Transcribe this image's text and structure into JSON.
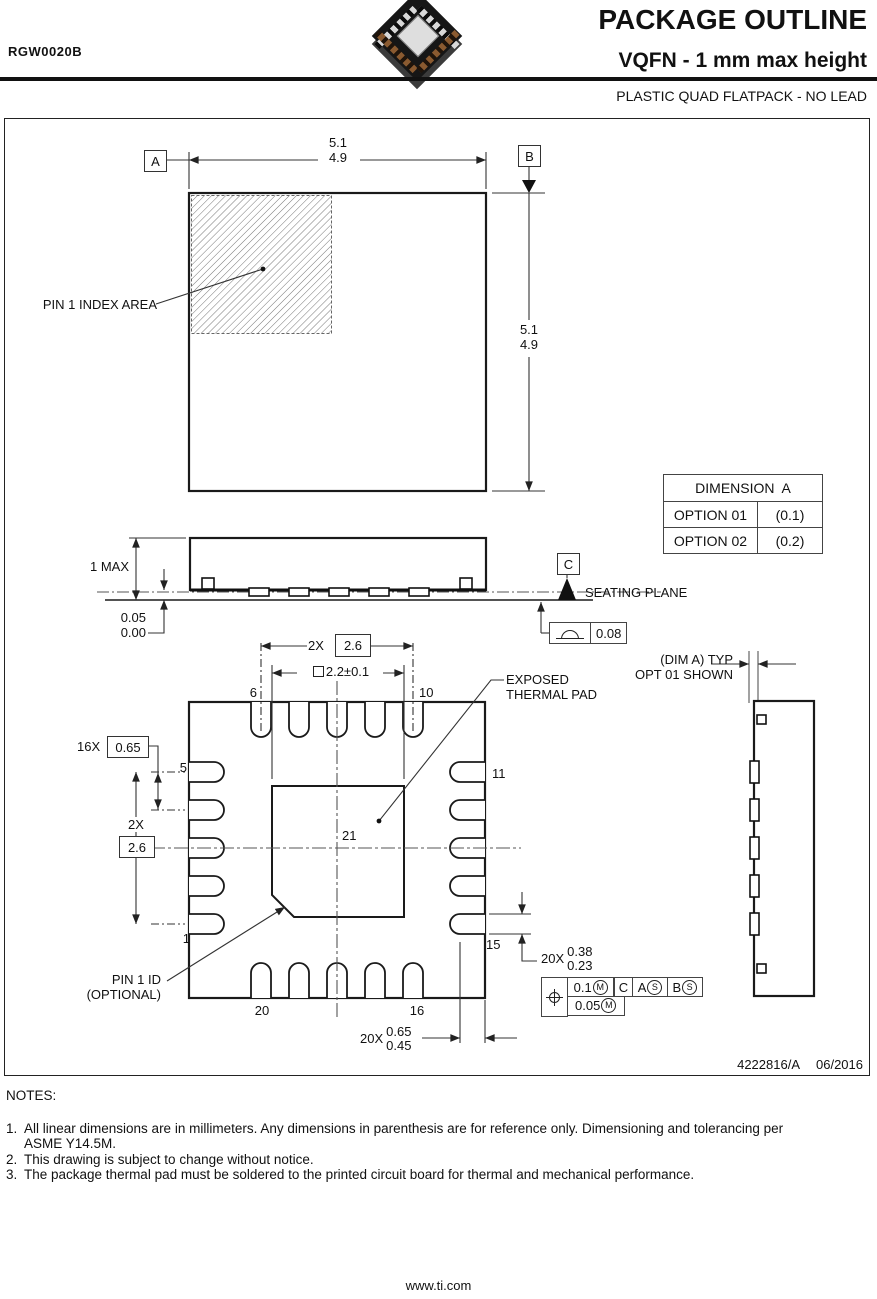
{
  "header": {
    "part_number": "RGW0020B",
    "title": "PACKAGE OUTLINE",
    "subtitle": "VQFN - 1 mm max height",
    "package_type": "PLASTIC QUAD FLATPACK - NO LEAD"
  },
  "top_view": {
    "datum_a": "A",
    "datum_b": "B",
    "width_max": "5.1",
    "width_min": "4.9",
    "height_max": "5.1",
    "height_min": "4.9",
    "pin1_index_label": "PIN 1 INDEX AREA"
  },
  "side_view": {
    "height_max_label": "1 MAX",
    "standoff_max": "0.05",
    "standoff_min": "0.00",
    "datum_c": "C",
    "seating_plane_label": "SEATING PLANE",
    "flatness_tolerance": "0.08"
  },
  "dimension_table": {
    "title": "DIMENSION  A",
    "rows": [
      {
        "option": "OPTION 01",
        "value": "(0.1)"
      },
      {
        "option": "OPTION 02",
        "value": "(0.2)"
      }
    ]
  },
  "bottom_view": {
    "top_pitch_qty": "2X",
    "top_pitch": "2.6",
    "pad_size": "2.2±0.1",
    "exposed_pad_line1": "EXPOSED",
    "exposed_pad_line2": "THERMAL PAD",
    "dim_a_line1": "(DIM A) TYP",
    "dim_a_line2": "OPT 01 SHOWN",
    "pitch_qty": "16X",
    "pitch": "0.65",
    "left_pitch_qty": "2X",
    "left_pitch": "2.6",
    "pin1_id_line1": "PIN 1 ID",
    "pin1_id_line2": "(OPTIONAL)",
    "lead_width_qty": "20X",
    "lead_width_max": "0.38",
    "lead_width_min": "0.23",
    "lead_length_qty": "20X",
    "lead_length_max": "0.65",
    "lead_length_min": "0.45",
    "pins": {
      "p1": "1",
      "p5": "5",
      "p6": "6",
      "p10": "10",
      "p11": "11",
      "p15": "15",
      "p16": "16",
      "p20": "20",
      "p21": "21"
    },
    "fcf": {
      "tol_primary": "0.1",
      "mod_primary": "M",
      "datum_ref1": "C",
      "datum_ref2": "A",
      "mod2": "S",
      "datum_ref3": "B",
      "mod3": "S",
      "tol_secondary": "0.05",
      "mod_secondary": "M"
    }
  },
  "footer": {
    "doc_number": "4222816/A",
    "date": "06/2016"
  },
  "notes": {
    "title": "NOTES:",
    "items": [
      {
        "num": "1.",
        "text": "All linear dimensions are in millimeters. Any dimensions in parenthesis are for reference only. Dimensioning and tolerancing per ASME Y14.5M."
      },
      {
        "num": "2.",
        "text": "This drawing is subject to change without notice."
      },
      {
        "num": "3.",
        "text": "The package thermal pad must be soldered to the printed circuit board for thermal and mechanical performance."
      }
    ]
  },
  "website": "www.ti.com"
}
